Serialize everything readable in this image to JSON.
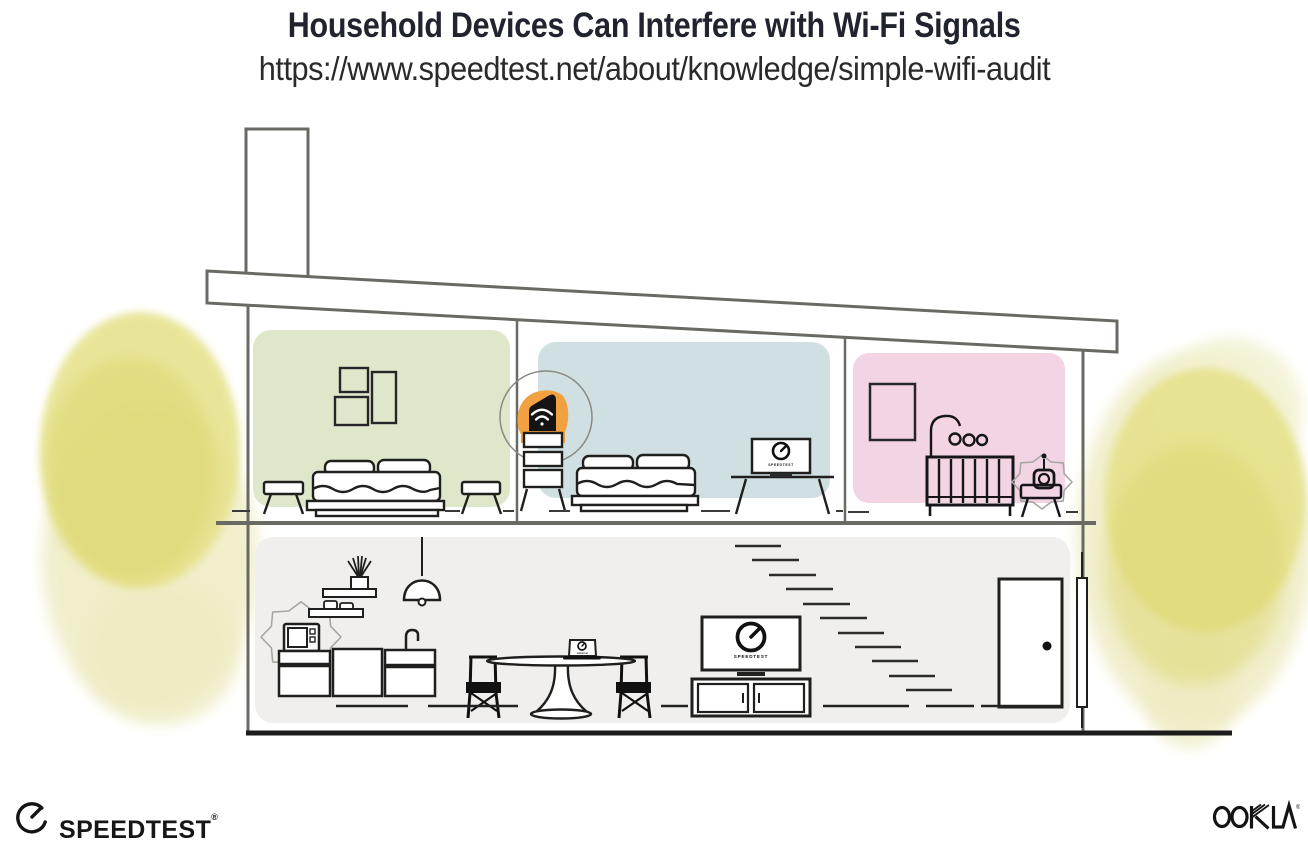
{
  "header": {
    "title": "Household Devices Can Interfere with Wi-Fi Signals",
    "url": "https://www.speedtest.net/about/knowledge/simple-wifi-audit"
  },
  "scene": {
    "device_screen_label": "SPEEDTEST"
  },
  "footer": {
    "speedtest_label": "SPEEDTEST",
    "speedtest_trademark": "®",
    "ookla_label": "OOKLA",
    "ookla_trademark": "®"
  },
  "colors": {
    "title_text": "#21242f",
    "line_ink": "#1d1d1b",
    "wall_gray": "#6a6a64",
    "room_green": "#dfe7cb",
    "room_blue": "#cfdfe2",
    "room_pink": "#f3d4e4",
    "room_gray": "#f0efed",
    "router_highlight_orange": "#f1a13f",
    "foliage_yellow": "#e5e188",
    "foliage_yellow_light": "#efecc4"
  },
  "icons": {
    "router": "wifi-icon",
    "tv_screens": "speedometer-gauge-icon",
    "footer_logo": "speedometer-gauge-icon"
  }
}
